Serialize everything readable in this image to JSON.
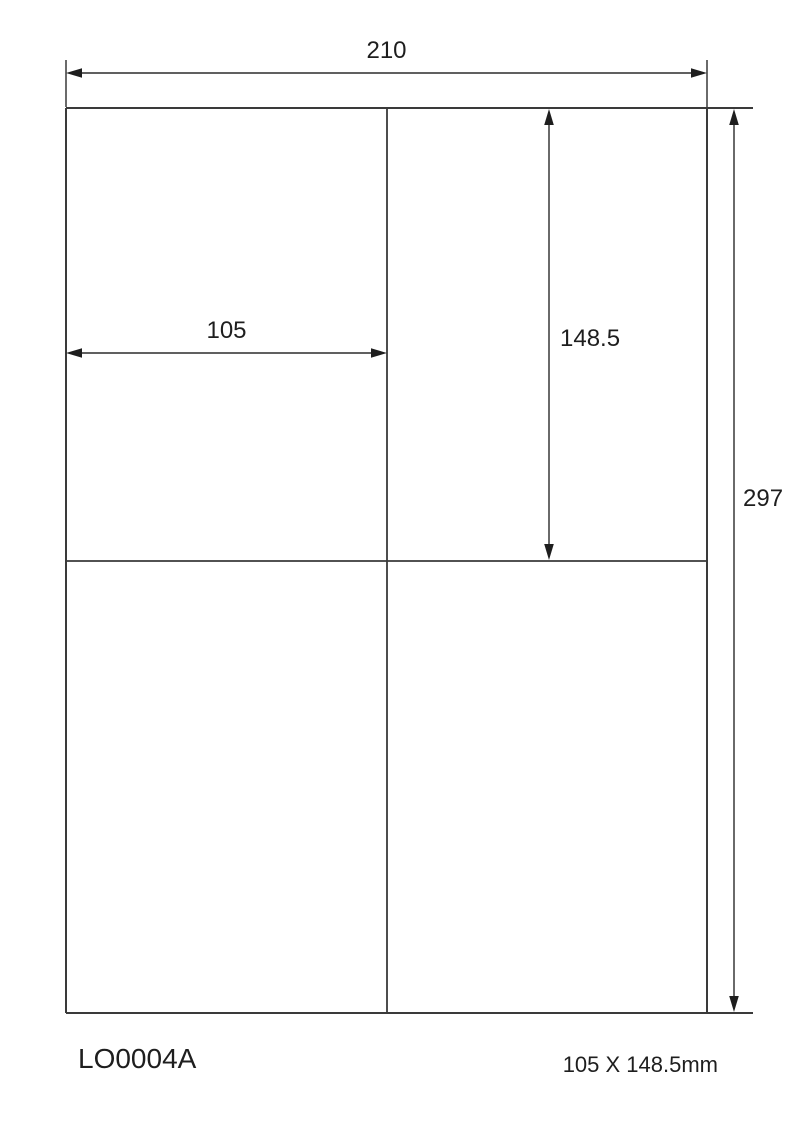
{
  "diagram": {
    "title": "label-sheet-dimension-drawing",
    "sheet": {
      "width_mm": "210",
      "height_mm": "297"
    },
    "label": {
      "width_mm": "105",
      "height_mm": "148.5"
    },
    "grid": {
      "columns": 2,
      "rows": 2
    },
    "footer": {
      "product_code": "LO0004A",
      "label_size": "105 X 148.5mm"
    },
    "colors": {
      "line": "#3a3a3a",
      "dimension_line": "#2b2b2b",
      "text": "#1e1e1e",
      "background": "#ffffff"
    }
  }
}
